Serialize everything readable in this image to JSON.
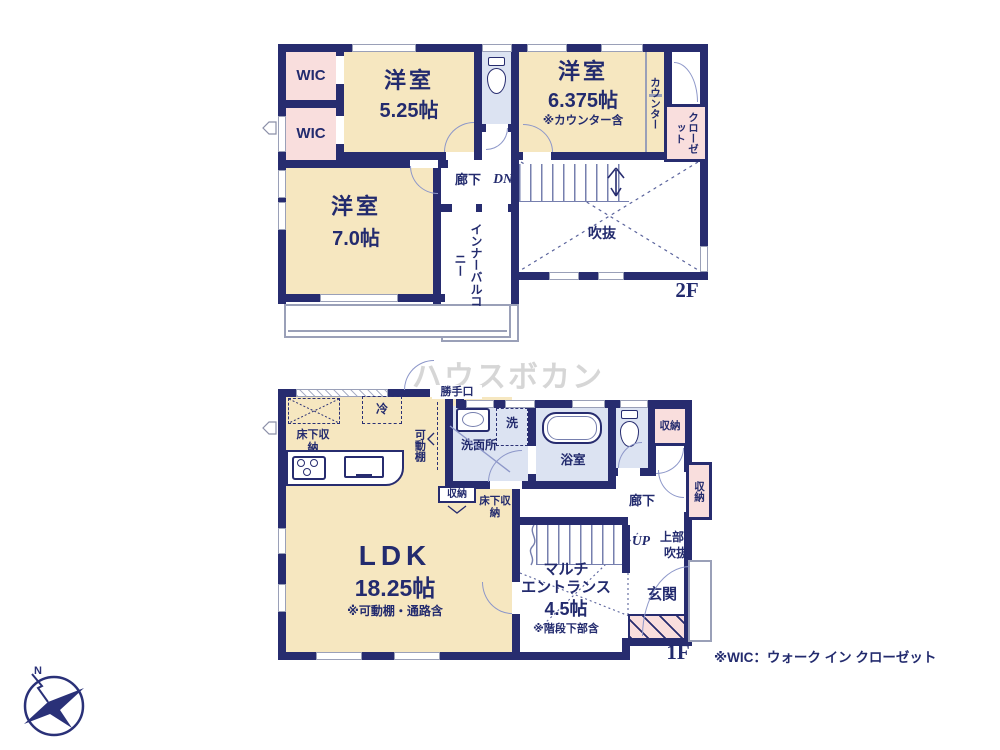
{
  "watermark": "ハウスボカン",
  "note": "※WIC：ウォーク イン クローゼット",
  "compass": {
    "n": "N"
  },
  "floor2": {
    "label": "2F",
    "wic1": "WIC",
    "wic2": "WIC",
    "bed1": {
      "name": "洋室",
      "size": "5.25帖"
    },
    "bed2": {
      "name": "洋室",
      "size": "6.375帖",
      "note": "※カウンター含"
    },
    "counter": "カウンター",
    "closet": "クローゼット",
    "hall": "廊下",
    "dn": "DN",
    "void": "吹抜",
    "bed3": {
      "name": "洋室",
      "size": "7.0帖"
    },
    "inner_balcony": "インナーバルコニー"
  },
  "floor1": {
    "label": "1F",
    "back_door": "勝手口",
    "fridge": "冷",
    "floor_storage_kitchen": "床下収納",
    "movable_shelf": "可動棚",
    "storage_small": "収納",
    "floor_storage_2": "床下収納",
    "washroom": "洗面所",
    "washer": "洗",
    "bath": "浴室",
    "storage_top": "収納",
    "storage_right": "収納",
    "hall": "廊下",
    "up": "UP",
    "upper_void_l1": "上部",
    "upper_void_l2": "吹抜",
    "ldk": {
      "name": "LDK",
      "size": "18.25帖",
      "note": "※可動棚・通路含"
    },
    "entrance_hall": {
      "line1": "マルチ",
      "line2": "エントランス",
      "size": "4.5帖",
      "note": "※階段下部含"
    },
    "genkan": "玄関"
  }
}
